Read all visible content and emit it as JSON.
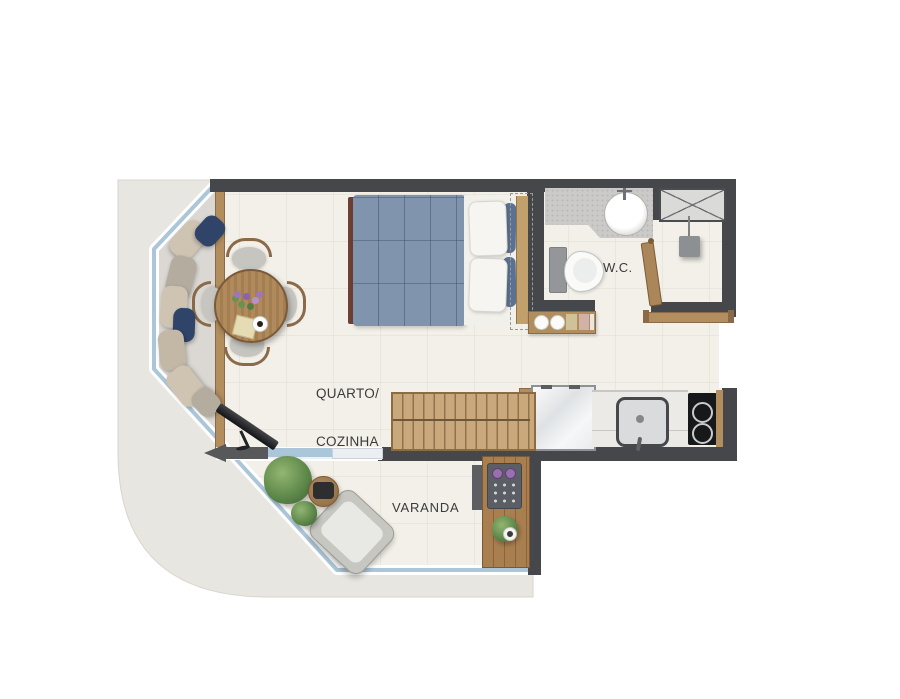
{
  "labels": {
    "room_line1": "QUARTO/",
    "room_line2": "COZINHA",
    "wc": "W.C.",
    "balcony": "VARANDA"
  },
  "rooms": [
    {
      "name": "quarto-cozinha",
      "label": "QUARTO/COZINHA"
    },
    {
      "name": "wc",
      "label": "W.C."
    },
    {
      "name": "varanda",
      "label": "VARANDA"
    }
  ],
  "furniture": [
    "double-bed",
    "wardrobe-outline",
    "bedside-console",
    "dining-table",
    "dining-chairs",
    "bay-window-cushions",
    "tv",
    "sliding-glass-door",
    "entrance-arrow",
    "bar-table",
    "refrigerator",
    "kitchen-sink",
    "cooktop",
    "washbasin",
    "toilet",
    "shower",
    "bathroom-window",
    "towel-bar",
    "wc-door",
    "barbecue-grill",
    "lounge-chair",
    "side-table",
    "plants",
    "glass-balustrade"
  ],
  "colors": {
    "wall": "#45474b",
    "floor": "#f3f0e9",
    "floor_grid": "#e3e0d7",
    "slab": "#e8e6e1",
    "bay_floor": "#dbd8d3",
    "glass": "#aac6d8",
    "glazing_frame": "#ffffff",
    "wood": "#b28d5e",
    "wood_dark": "#8a6a48",
    "wood_light": "#c9a97c",
    "blanket": "#8095ad",
    "navy": "#2f4468",
    "cushion": "#cfc3b2",
    "cushion_gray": "#b5aca0",
    "granite": "#cbcac8",
    "appliance": "#17181a",
    "steel": "#8d9093",
    "grill_knob": "#9a6fb0",
    "plant": "#5f8a4b",
    "maroon": "#6e3f35",
    "label": "#3b3b3b",
    "arrow": "#56585a"
  }
}
